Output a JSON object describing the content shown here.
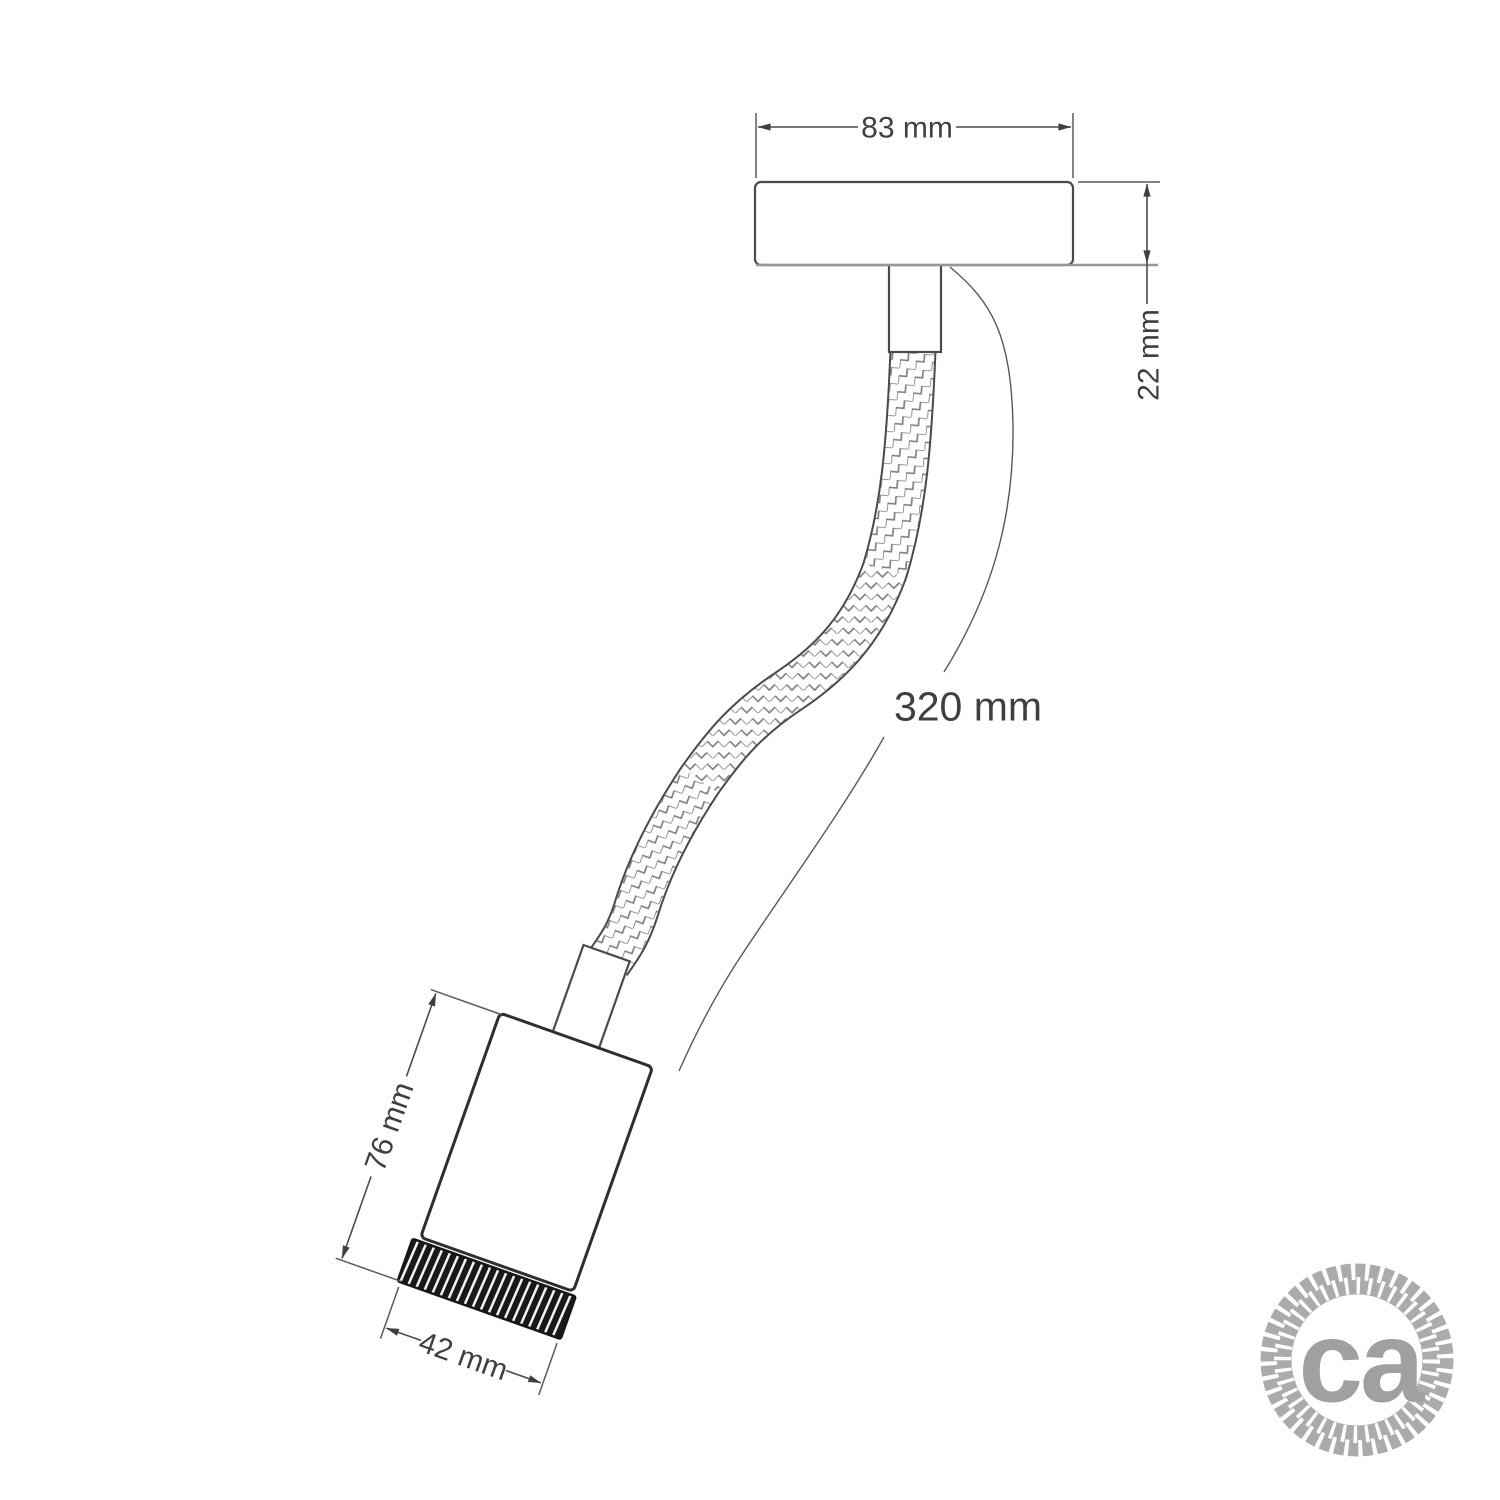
{
  "dimensions": {
    "canopy_width": "83 mm",
    "canopy_depth": "22 mm",
    "flex_arm_length": "320 mm",
    "holder_length": "76 mm",
    "holder_diameter": "42 mm"
  },
  "logo": {
    "text": "ca",
    "icon": "rope-circle",
    "color": "#9fa0a2"
  },
  "colors": {
    "background": "#ffffff",
    "line_dark": "#3f3f3f",
    "line_light": "#969696",
    "label_text": "#3d3f42",
    "braid_line": "#787878",
    "knurl_dark": "#191919"
  }
}
